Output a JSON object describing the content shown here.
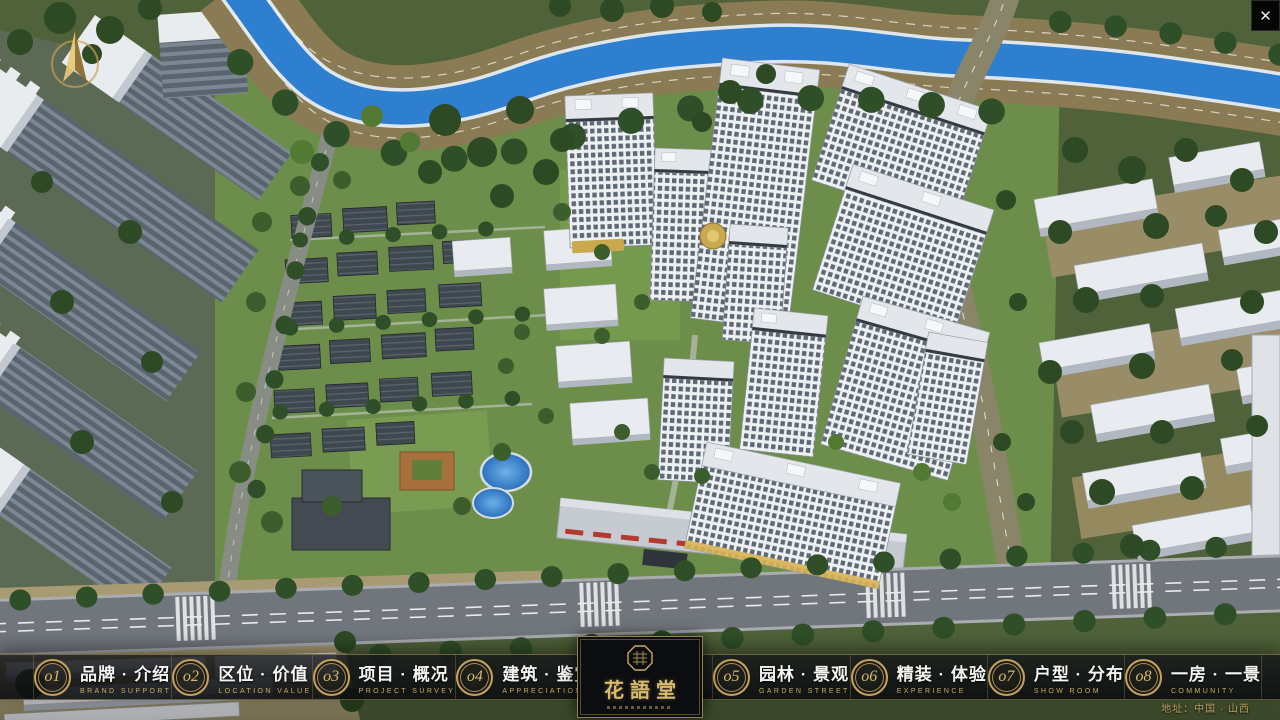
{
  "window": {
    "close_label": "✕"
  },
  "logo": {
    "title": "花語堂"
  },
  "menu": [
    {
      "num": "o1",
      "title": "品牌 · 介绍",
      "subtitle": "BRAND SUPPORT"
    },
    {
      "num": "o2",
      "title": "区位 · 价值",
      "subtitle": "LOCATION VALUE"
    },
    {
      "num": "o3",
      "title": "项目 · 概况",
      "subtitle": "PROJECT SURVEY"
    },
    {
      "num": "o4",
      "title": "建筑 · 鉴赏",
      "subtitle": "APPRECIATION"
    },
    {
      "num": "o5",
      "title": "园林 · 景观",
      "subtitle": "GARDEN STREET"
    },
    {
      "num": "o6",
      "title": "精装 · 体验",
      "subtitle": "EXPERIENCE"
    },
    {
      "num": "o7",
      "title": "户型 · 分布",
      "subtitle": "SHOW ROOM"
    },
    {
      "num": "o8",
      "title": "一房 · 一景",
      "subtitle": "COMMUNITY"
    }
  ],
  "footer": {
    "address": "地址：中国 · 山西"
  },
  "colors": {
    "gold": "#c5a25c",
    "river": "#2f7fd0",
    "bar_bg": "#12161a"
  }
}
